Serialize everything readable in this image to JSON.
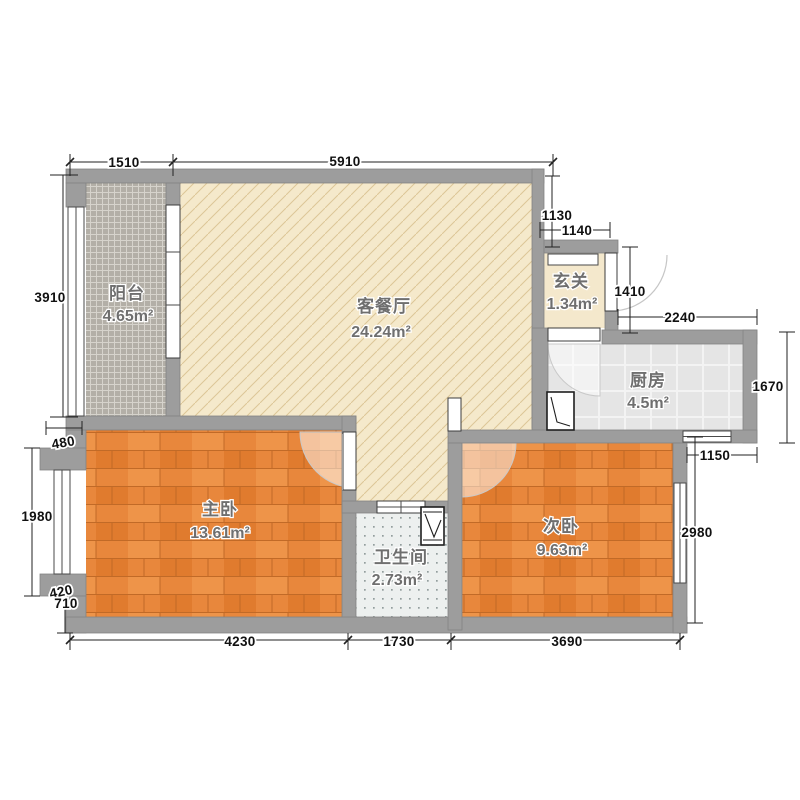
{
  "plan_title": "two-bedroom-apartment-floor-plan",
  "rooms": [
    {
      "name": "阳台",
      "area": "4.65m²"
    },
    {
      "name": "客餐厅",
      "area": "24.24m²"
    },
    {
      "name": "玄关",
      "area": "1.34m²"
    },
    {
      "name": "厨房",
      "area": "4.5m²"
    },
    {
      "name": "主卧",
      "area": "13.61m²"
    },
    {
      "name": "卫生间",
      "area": "2.73m²"
    },
    {
      "name": "次卧",
      "area": "9.63m²"
    }
  ],
  "dims": {
    "top": [
      "1510",
      "5910"
    ],
    "upper_right": [
      "1130",
      "1140",
      "1410",
      "2240"
    ],
    "right": [
      "1670",
      "1150",
      "2980"
    ],
    "left": [
      "3910",
      "480",
      "1980",
      "420",
      "710"
    ],
    "bottom": [
      "4230",
      "1730",
      "3690"
    ]
  },
  "colors": {
    "wall": "#9d9d9d",
    "wood_floor": "#e8873c",
    "living_floor": "#f5e9cb",
    "balcony_tile": "#b3afa7",
    "kitchen_tile": "#e5e5e5",
    "bath_tile": "#edf0ef",
    "dim_text": "#111111",
    "room_label": "#6f6f6f"
  }
}
